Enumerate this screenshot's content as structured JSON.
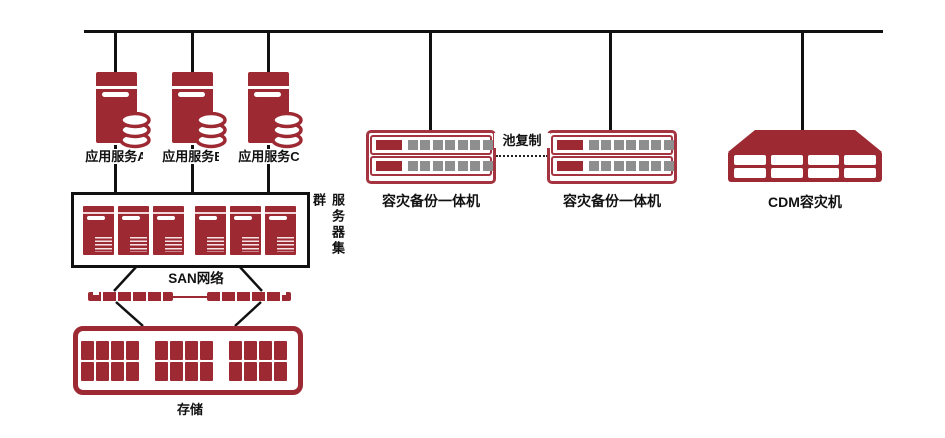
{
  "colors": {
    "primary_red": "#9D2933",
    "appliance_border_red": "#A43440",
    "connector_black": "#111111",
    "disk_gray": "#8E8E8E"
  },
  "app_servers": [
    {
      "label": "应用服务A"
    },
    {
      "label": "应用服务B"
    },
    {
      "label": "应用服务C"
    }
  ],
  "server_cluster": {
    "label": "服务器集群"
  },
  "san_network": {
    "label": "SAN网络"
  },
  "storage": {
    "label": "存储"
  },
  "dr_appliances": [
    {
      "label": "容灾备份一体机"
    },
    {
      "label": "容灾备份一体机"
    }
  ],
  "replication": {
    "label": "池复制"
  },
  "cdm": {
    "label": "CDM容灾机"
  }
}
